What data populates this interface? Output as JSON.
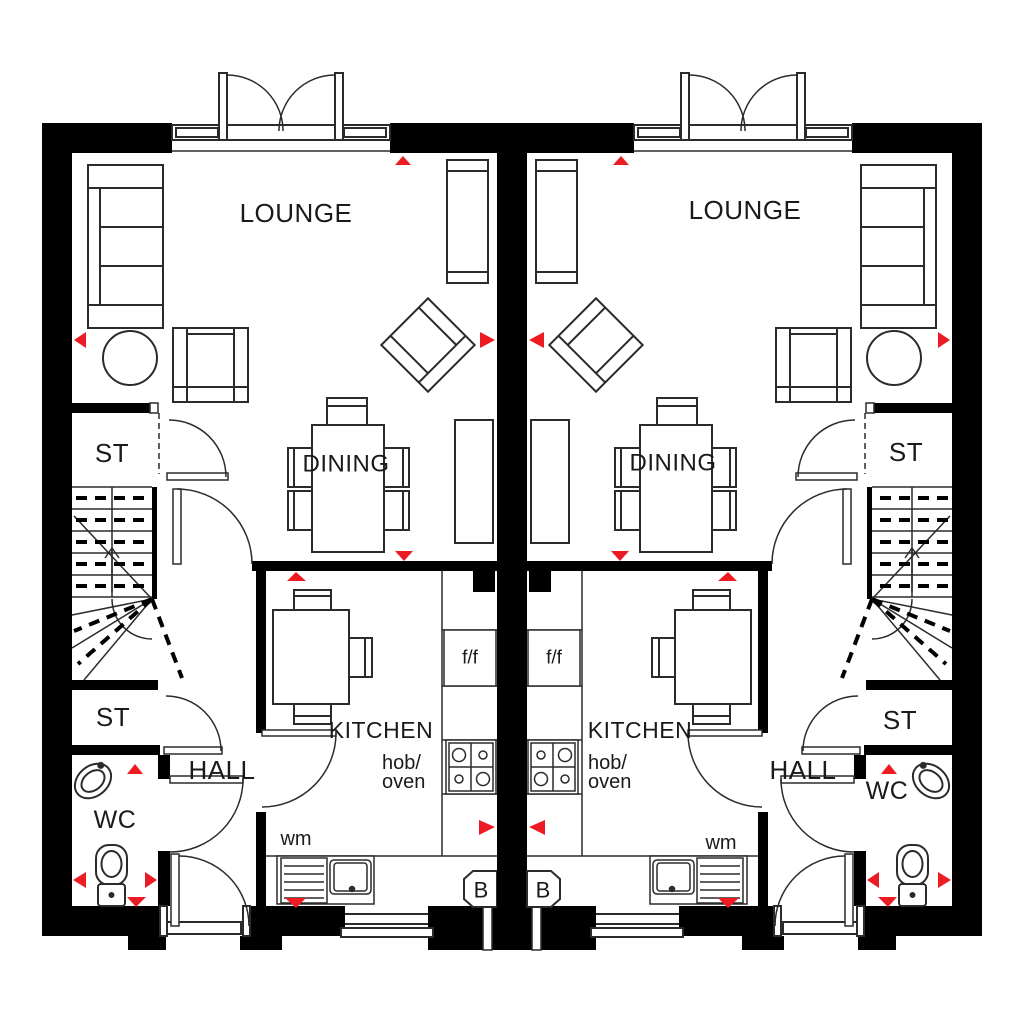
{
  "plan": {
    "type": "ground-floor-plan",
    "description": "Two mirrored terraced house ground floor plans",
    "colors": {
      "walls": "#000000",
      "lines": "#2b2b2b",
      "accent": "#ed1c24",
      "background": "#ffffff"
    },
    "houses": [
      {
        "id": "left-house",
        "labels": {
          "lounge": "LOUNGE",
          "dining": "DINING",
          "kitchen": "KITCHEN",
          "hob_oven_line1": "hob/",
          "hob_oven_line2": "oven",
          "store_upper": "ST",
          "store_lower": "ST",
          "hall": "HALL",
          "wc": "WC",
          "washing_machine": "wm",
          "fridge_freezer": "f/f",
          "boiler": "B"
        }
      },
      {
        "id": "right-house",
        "labels": {
          "lounge": "LOUNGE",
          "dining": "DINING",
          "kitchen": "KITCHEN",
          "hob_oven_line1": "hob/",
          "hob_oven_line2": "oven",
          "store_upper": "ST",
          "store_lower": "ST",
          "hall": "HALL",
          "wc": "WC",
          "washing_machine": "wm",
          "fridge_freezer": "f/f",
          "boiler": "B"
        }
      }
    ]
  }
}
